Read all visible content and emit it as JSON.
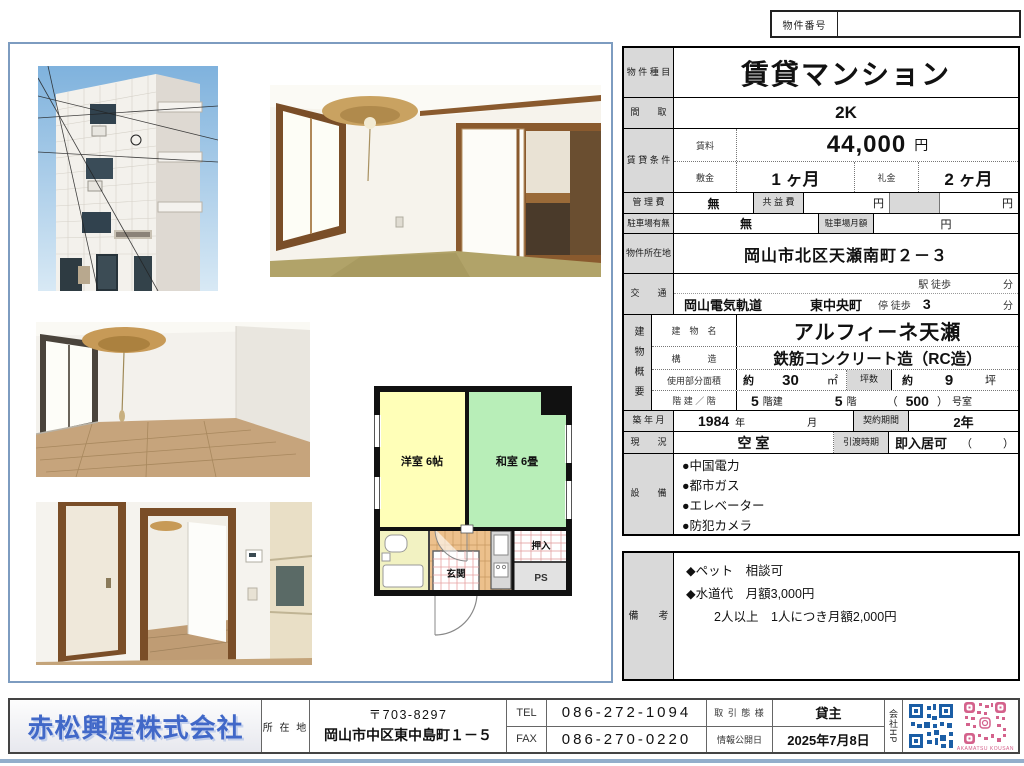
{
  "property_number": {
    "label": "物件番号",
    "value": ""
  },
  "main_table": {
    "type_label": "物 件 種 目",
    "type_value": "賃貸マンション",
    "madori_label": "間　　取",
    "madori_value": "2K",
    "conditions_label": "賃 貸 条 件",
    "rent_label": "賃料",
    "rent_value": "44,000",
    "yen": "円",
    "deposit_label": "敷金",
    "deposit_value": "1 ヶ月",
    "reikin_label": "礼金",
    "reikin_value": "2 ヶ月",
    "kanrihi_label": "管 理 費",
    "kanrihi_value": "無",
    "kyoekihi_label": "共 益 費",
    "parking_label": "駐車場有無",
    "parking_value": "無",
    "parking_monthly_label": "駐車場月額",
    "address_label": "物件所在地",
    "address_value": "岡山市北区天瀬南町２－３",
    "kotsu_label": "交　　通",
    "eki_label": "駅 徒歩",
    "fun_label": "分",
    "rail_company": "岡山電気軌道",
    "stop_name": "東中央町",
    "stop_label": "停 徒歩",
    "stop_min": "3",
    "building_label": "建物概要",
    "bldg_name_label": "建　物　名",
    "bldg_name": "アルフィーネ天瀬",
    "structure_label": "構　　　造",
    "structure": "鉄筋コンクリート造（RC造）",
    "area_label": "使用部分面積",
    "area_approx": "約",
    "area_value": "30",
    "area_unit": "㎡",
    "tsubo_label": "坪数",
    "tsubo_approx": "約",
    "tsubo_value": "9",
    "tsubo_unit": "坪",
    "floors_label": "階 建 ／ 階",
    "floors_bldg_value": "5",
    "floors_bldg_unit": "階建",
    "floor_value": "5",
    "floor_unit": "階",
    "room_open": "（",
    "room_number": "500",
    "room_close": "）",
    "room_unit": "号室",
    "built_label": "築 年 月",
    "built_year": "1984",
    "built_year_unit": "年",
    "built_month_unit": "月",
    "contract_label": "契約期間",
    "contract_value": "2年",
    "genkyo_label": "現　　況",
    "genkyo_value": "空 室",
    "hikiwatashi_label": "引渡時期",
    "hikiwatashi_value": "即入居可",
    "paren_open": "（",
    "paren_close": "）",
    "setsubi_label": "設　　備",
    "equipment": [
      "●中国電力",
      "●都市ガス",
      "●エレベーター",
      "●防犯カメラ"
    ]
  },
  "remarks": {
    "label": "備　　考",
    "items": [
      "◆ペット　相談可",
      "◆水道代　月額3,000円",
      "2人以上　1人につき月額2,000円"
    ]
  },
  "floor_plan": {
    "room_west": "洋室 6帖",
    "room_japanese": "和室 6畳",
    "entrance": "玄関",
    "closet": "押入",
    "pipe_space": "PS"
  },
  "footer": {
    "company_name": "赤松興産株式会社",
    "address_label": "所 在 地",
    "postal": "〒703-8297",
    "address": "岡山市中区東中島町１－５",
    "tel_label": "TEL",
    "tel": "086-272-1094",
    "fax_label": "FAX",
    "fax": "086-270-0220",
    "deal_label": "取 引 態 様",
    "deal_value": "貸主",
    "publish_label": "情報公開日",
    "publish_value": "2025年7月8日",
    "hp_label": "会社HP",
    "qr_caption": "AKAMATSU KOUSAN"
  },
  "colors": {
    "accent_blue": "#4168c8",
    "panel_border": "#7d9cc0",
    "qr_blue": "#1b5ea6",
    "qr_pink": "#d4628c"
  }
}
